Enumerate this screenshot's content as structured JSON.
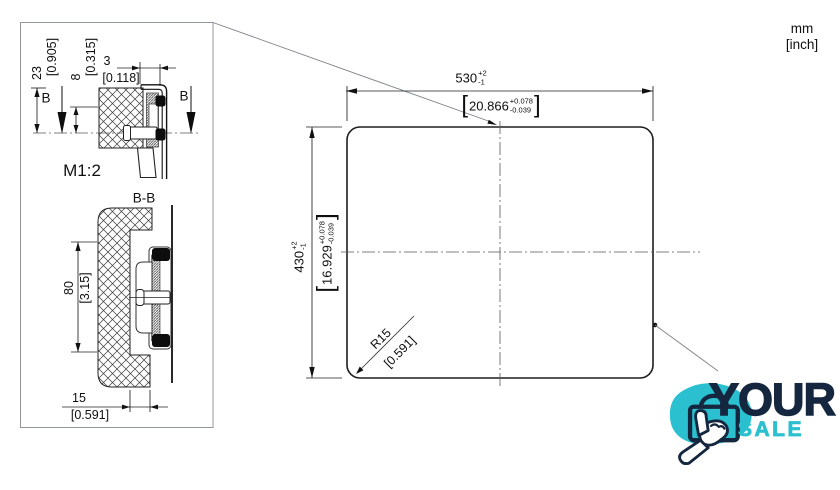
{
  "units": {
    "mm": "mm",
    "inch": "[inch]"
  },
  "symbols": {
    "bracket_open": "[",
    "bracket_close": "]"
  },
  "cutout_view": {
    "width": {
      "value": "530",
      "plus": "+2",
      "minus": "-1",
      "inch": "20.866",
      "inch_plus": "+0.078",
      "inch_minus": "-0.039"
    },
    "height": {
      "value": "430",
      "plus": "+2",
      "minus": "-1",
      "inch": "16.929",
      "inch_plus": "+0.078",
      "inch_minus": "-0.039"
    },
    "corner_radius": {
      "value": "R15",
      "inch": "[0.591]"
    }
  },
  "detail_view": {
    "scale": "M1:2",
    "section_marker_left": "B",
    "section_marker_right": "B",
    "dim_23": {
      "value": "23",
      "inch": "[0.905]"
    },
    "dim_8": {
      "value": "8",
      "inch": "[0.315]"
    },
    "dim_3": {
      "value": "3",
      "inch": "[0.118]"
    }
  },
  "section_view": {
    "label": "B-B",
    "dim_80": {
      "value": "80",
      "inch": "[3.15]"
    },
    "dim_15": {
      "value": "15",
      "inch": "[0.591]"
    }
  },
  "logo": {
    "line1": "YOUR",
    "line2": "SALE"
  },
  "colors": {
    "teal": "#2ac0cf",
    "navy": "#15273f",
    "line": "#1a1a1a"
  }
}
